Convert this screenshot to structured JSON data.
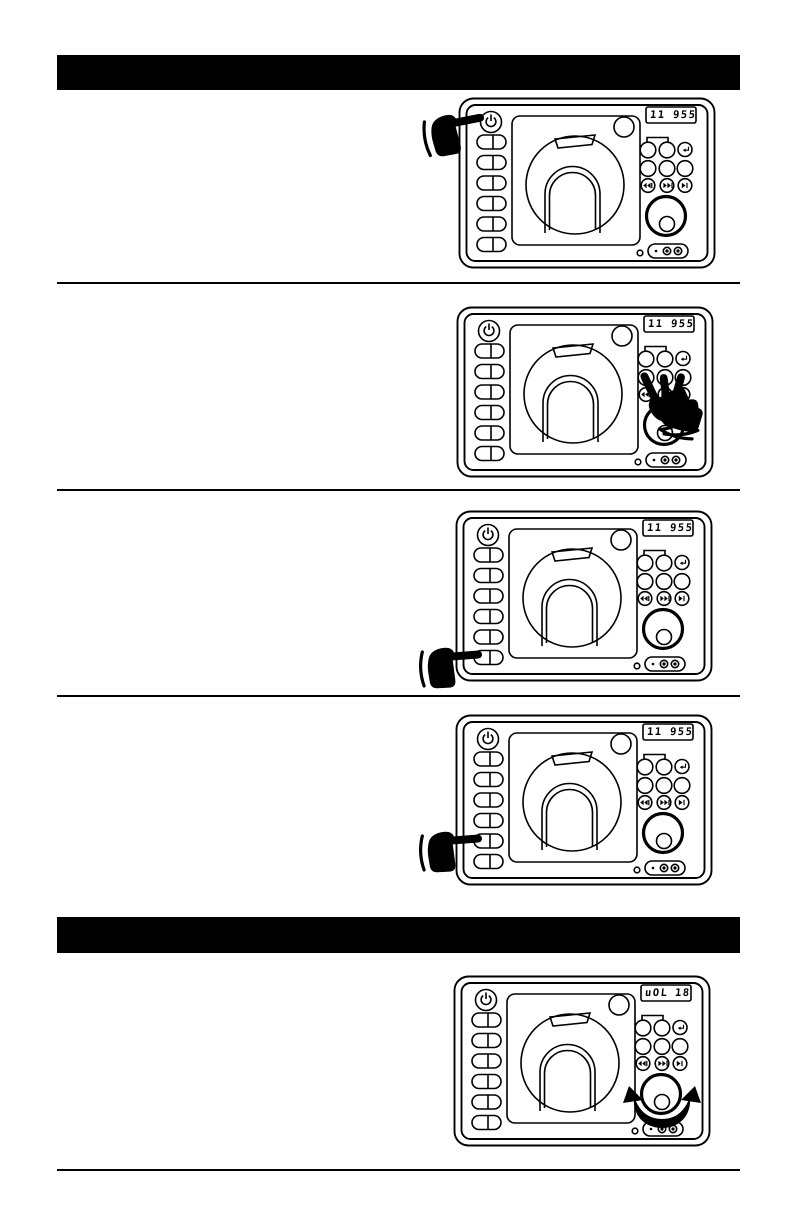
{
  "page": {
    "width": 793,
    "height": 1225,
    "background": "#ffffff",
    "ink": "#000000"
  },
  "header_bars": [
    {
      "id": "top-section-header",
      "style": "solid-black-bar",
      "text": ""
    },
    {
      "id": "middle-section-header",
      "style": "solid-black-bar",
      "text": ""
    }
  ],
  "steps": [
    {
      "name": "step-1",
      "display_left": "11",
      "display_right": "955",
      "hand": "press-power-button"
    },
    {
      "name": "step-2",
      "display_left": "11",
      "display_right": "955",
      "hand": "press-middle-row-buttons"
    },
    {
      "name": "step-3",
      "display_left": "11",
      "display_right": "955",
      "hand": "press-left-side-button-6"
    },
    {
      "name": "step-4",
      "display_left": "11",
      "display_right": "955",
      "hand": "press-left-side-button-5"
    },
    {
      "name": "step-5",
      "display_left": "uOL",
      "display_right": "18",
      "hand": "rotate-volume-knob"
    }
  ],
  "icons": {
    "power": "⏻",
    "return": "↵",
    "prev_track": "⏮",
    "next_track": "⏭",
    "play": "⏵",
    "pointing_hand": "☛",
    "rotate_arrow": "↻"
  }
}
